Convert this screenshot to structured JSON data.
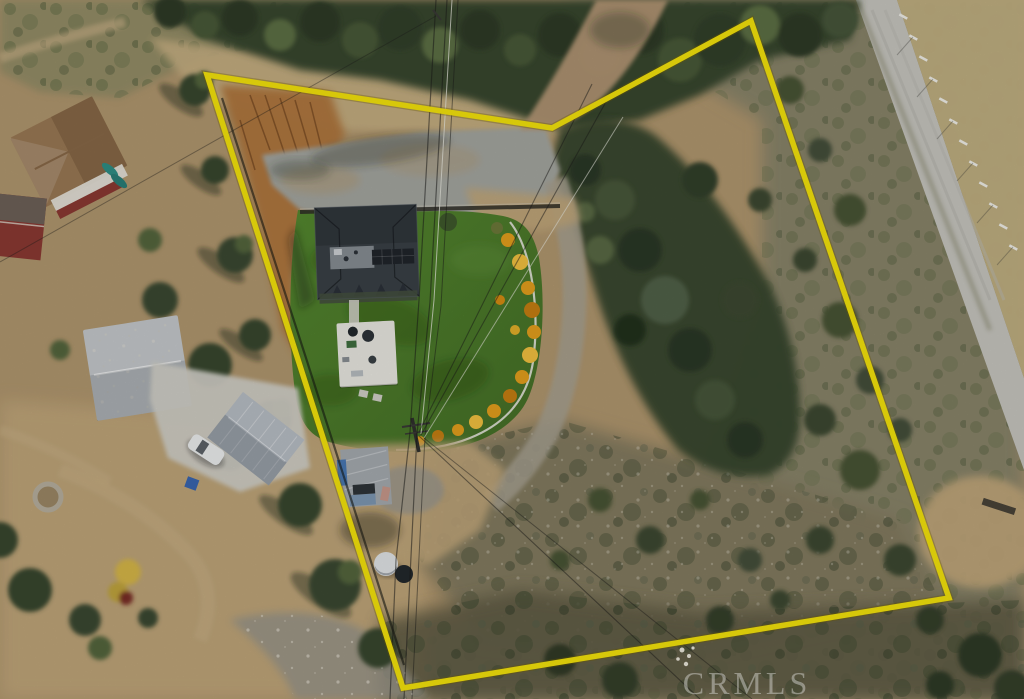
{
  "image": {
    "kind": "aerial-drone-photograph",
    "subject": "rural residential property with yellow parcel boundary overlay",
    "width": 1024,
    "height": 699
  },
  "watermark": {
    "text": "CRMLS"
  },
  "boundary": {
    "points": "207,75 552,128 751,21 949,598 403,688",
    "color": "#f6e50c",
    "stroke_width": 5.5
  },
  "features": [
    "main-house-dark-roof",
    "artificial-turf-lawn",
    "yellow-flower-border",
    "gravel-parking-pad",
    "dirt-entrance-driveway",
    "white-patio-structure",
    "tarp-covered-shed",
    "white-dome-tank",
    "utility-pole-and-power-lines",
    "neighbor-brown-roof-house",
    "neighbor-red-building",
    "neighbor-white-roof-house",
    "neighbor-metal-garage",
    "white-pickup-truck",
    "paved-road-with-fence-posts",
    "chaparral-brush",
    "oak-tree-groves",
    "tan-dirt-clearing",
    "rock-wash"
  ],
  "palette": {
    "boundary": "#f6e50c",
    "dirt": "#b2986f",
    "dirt2": "#c2a87c",
    "dirtOrange": "#b1773c",
    "grassDry": "#c8b183",
    "grassDry2": "#c4b284",
    "scrub": "#8f8c66",
    "chap": "#8a856a",
    "scrubLow": "#847b61",
    "scrubDark": "#615c45",
    "wash": "#9a968a",
    "treeDark": "#37462d",
    "treeMid": "#54663c",
    "road": "#c8c7c0",
    "gravel": "#a5a7a1",
    "gravel2": "#a9a393",
    "drive": "#b59876",
    "lawn1": "#55892f",
    "lawn2": "#456f27",
    "flower": "#e5a01d",
    "roofDark": "#3a4046",
    "roofFlat": "#878e94",
    "solar": "#20252b",
    "white": "#ebeae3",
    "concrete": "#d3d1c9",
    "roofBrown": "#9b7a55",
    "wallRed": "#8c3a33",
    "roofLight": "#c6cacd",
    "metal": "#b9bfc6",
    "shed": "#a6acb1",
    "tarp": "#3f72b5",
    "watermark": "#f2f1ec"
  }
}
